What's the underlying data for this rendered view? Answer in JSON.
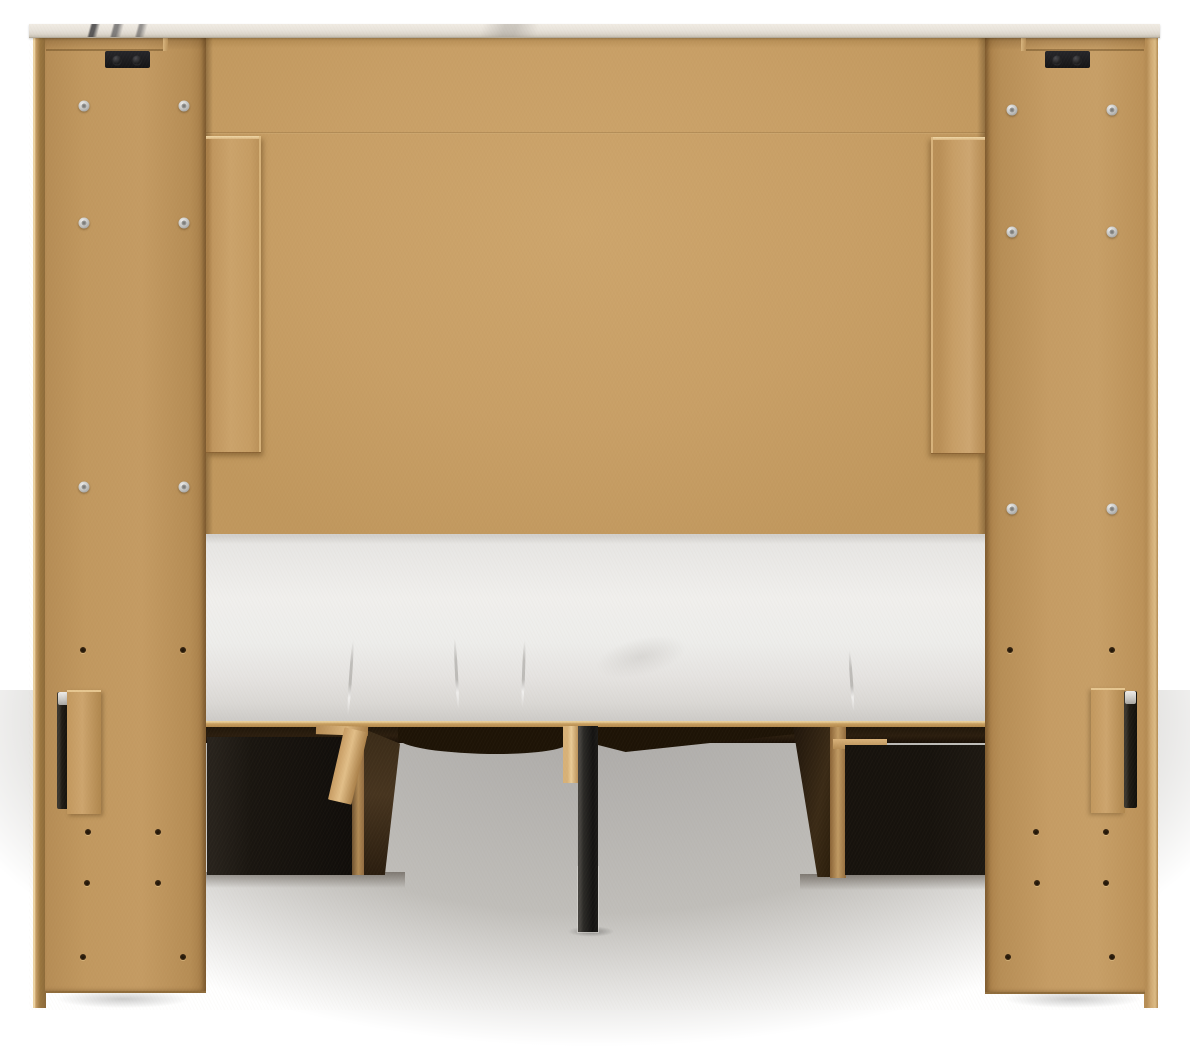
{
  "canvas": {
    "width": 1190,
    "height": 1050
  },
  "scene": {
    "kind": "furniture-product-photo",
    "subject": "Back view of a bed frame with headboard and under-bed storage drawers",
    "background": "white seamless studio backdrop with soft gray floor shadow",
    "visible_text": ""
  },
  "parts": {
    "top_cap": {
      "name": "marble-look top cap",
      "finish": "white faux marble with gray veining"
    },
    "back_panel": {
      "name": "headboard back panel",
      "material": "tan fibreboard (MDF)",
      "seams": 1
    },
    "left_column": {
      "name": "left side panel",
      "silver_screws": 6,
      "pilot_holes": 8,
      "top_brackets": 1,
      "rail_brackets": 1
    },
    "right_column": {
      "name": "right side panel",
      "silver_screws": 6,
      "pilot_holes": 8,
      "top_brackets": 1,
      "rail_brackets": 1
    },
    "leg_planks": {
      "name": "stepped headboard leg planks",
      "count": 2
    },
    "mattress": {
      "name": "mattress foundation",
      "finish": "white fabric with creases"
    },
    "platform": {
      "name": "platform deck edge",
      "material": "wood strip"
    },
    "drawers": {
      "name": "under-bed storage drawers",
      "count": 2,
      "finish": "black with raw wood edges"
    },
    "slats": {
      "name": "wood support slats",
      "count": 3
    },
    "center_leg": {
      "name": "center support leg",
      "material": "black metal"
    }
  },
  "palette": {
    "c-bg": "#ffffff",
    "c-floor": "#acaaa8",
    "c-mdf": "#c89f66",
    "c-mdf-light": "#f0d8a8",
    "c-marble": "#e8e3db",
    "c-mattress": "#ededeb",
    "c-platform": "#c79e60",
    "c-drawer": "#191510",
    "c-wood-edge": "#b18a54",
    "c-slat": "#dbb67e",
    "c-metal": "#131211",
    "c-bracket": "#141416",
    "c-screw": "#bebebc",
    "c-hole": "#3a2712"
  }
}
